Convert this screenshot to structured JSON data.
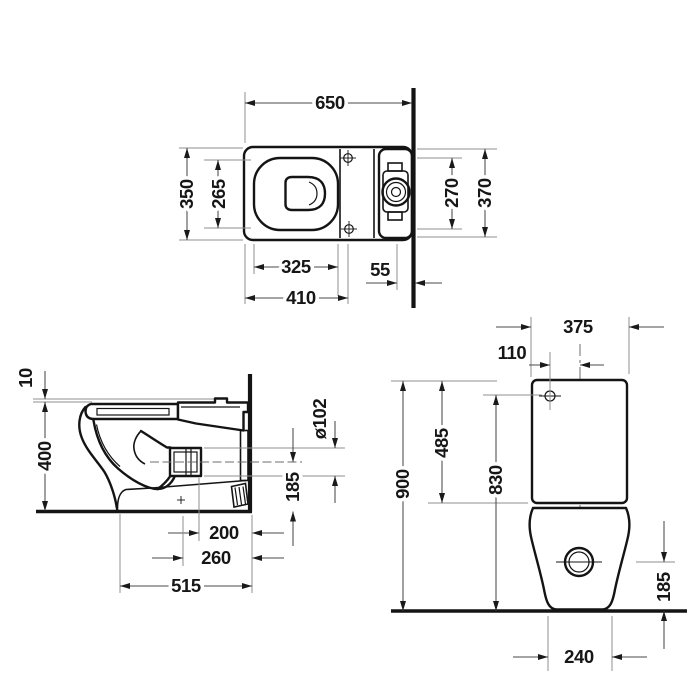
{
  "dims": {
    "top": {
      "total_depth": "650",
      "bowl_width": "350",
      "seat_opening_width": "265",
      "fixing_holes_spacing": "270",
      "tank_width": "370",
      "seat_opening_length": "325",
      "rear_gap": "55",
      "fixing_holes_distance": "410"
    },
    "side": {
      "seat_gap": "10",
      "rim_height": "400",
      "outlet_diameter": "ø102",
      "outlet_center_height": "185",
      "outlet_to_wall": "200",
      "trap_to_wall": "260",
      "total_depth": "515"
    },
    "front": {
      "tank_width": "375",
      "inlet_offset": "110",
      "total_height": "900",
      "tank_top_height": "485",
      "inlet_height": "830",
      "outlet_center_height": "185",
      "base_width": "240"
    }
  }
}
